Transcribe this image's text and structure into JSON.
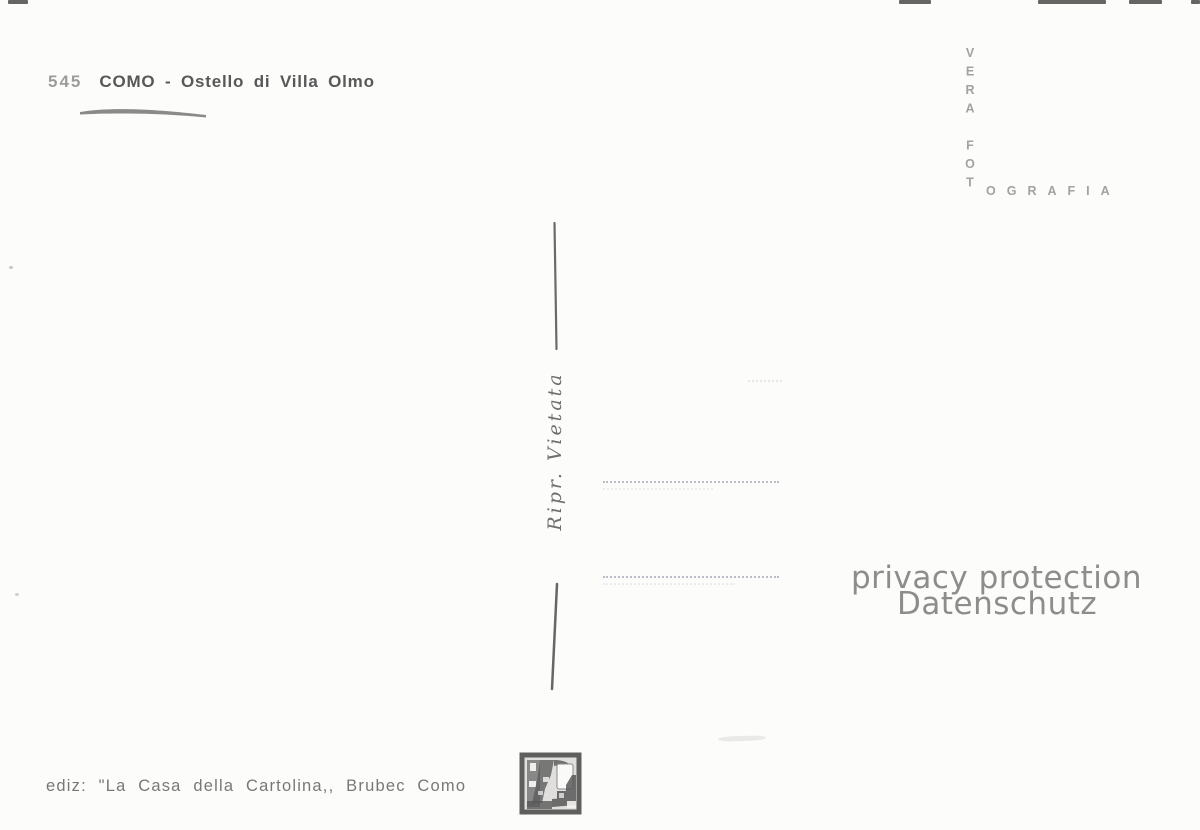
{
  "colors": {
    "ink_dark": "#585858",
    "ink_light": "#a2a2a2",
    "divider_ink": "#6a6a6a",
    "watermark_gray": "#8d8d8d",
    "dotted_line": "#b9bec6",
    "paper": "#fcfcfb"
  },
  "header": {
    "number": "545",
    "title": "COMO - Ostello di Villa Olmo"
  },
  "photographer_mark": {
    "vertical": "VERA FOT",
    "horizontal_rest": "OGRAFIA"
  },
  "divider": {
    "label": "Ripr. Vietata"
  },
  "watermark": {
    "line1": "privacy protection",
    "line2": "Datenschutz"
  },
  "publisher": {
    "line": "ediz: \"La Casa della Cartolina,, Brubec Como"
  },
  "icons": {
    "printer_stamp": "printer-stamp-icon"
  }
}
